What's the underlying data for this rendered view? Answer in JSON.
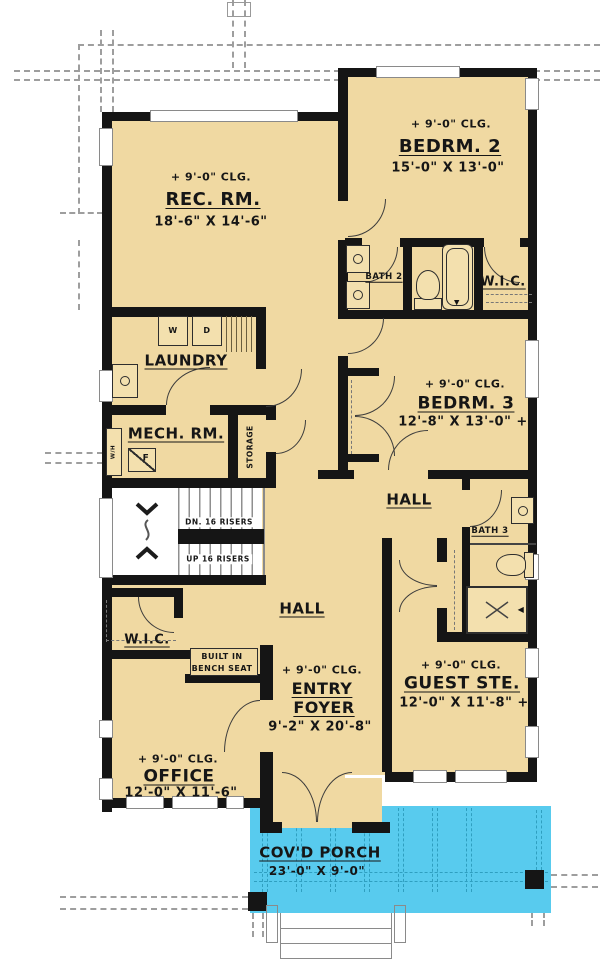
{
  "colors": {
    "floor": "#F0D9A2",
    "wall": "#151515",
    "porch": "#58CBEE",
    "porch_dash": "#2F9FC0",
    "roof_line": "#9E9E9E"
  },
  "rooms": {
    "rec_room": {
      "ceiling": "+ 9'-0\" CLG.",
      "name": "REC. RM.",
      "dims": "18'-6\" X 14'-6\""
    },
    "bedroom2": {
      "ceiling": "+ 9'-0\" CLG.",
      "name": "BEDRM. 2",
      "dims": "15'-0\" X 13'-0\""
    },
    "bath2": {
      "name": "BATH 2"
    },
    "wic_bedroom2": {
      "name": "W.I.C."
    },
    "laundry": {
      "name": "LAUNDRY",
      "washer": "W",
      "dryer": "D"
    },
    "mech_room": {
      "name": "MECH. RM.",
      "furnace": "F",
      "water_heater": "W/H"
    },
    "storage": {
      "name": "STORAGE"
    },
    "bedroom3": {
      "ceiling": "+ 9'-0\" CLG.",
      "name": "BEDRM. 3",
      "dims": "12'-8\" X 13'-0\" +"
    },
    "hall_upper": {
      "name": "HALL"
    },
    "bath3": {
      "name": "BATH 3"
    },
    "stairs": {
      "down": "DN. 16 RISERS",
      "up": "UP 16 RISERS"
    },
    "wic_entry": {
      "name": "W.I.C."
    },
    "bench": {
      "line1": "BUILT IN",
      "line2": "BENCH SEAT"
    },
    "hall_lower": {
      "name": "HALL"
    },
    "entry_foyer": {
      "ceiling": "+ 9'-0\" CLG.",
      "name_line1": "ENTRY",
      "name_line2": "FOYER",
      "dims": "9'-2\" X 20'-8\""
    },
    "guest_suite": {
      "ceiling": "+ 9'-0\" CLG.",
      "name": "GUEST STE.",
      "dims": "12'-0\" X 11'-8\" +"
    },
    "office": {
      "ceiling": "+ 9'-0\" CLG.",
      "name": "OFFICE",
      "dims": "12'-0\" X 11'-6\""
    },
    "covered_porch": {
      "name": "COV'D PORCH",
      "dims": "23'-0\" X 9'-0\""
    }
  }
}
